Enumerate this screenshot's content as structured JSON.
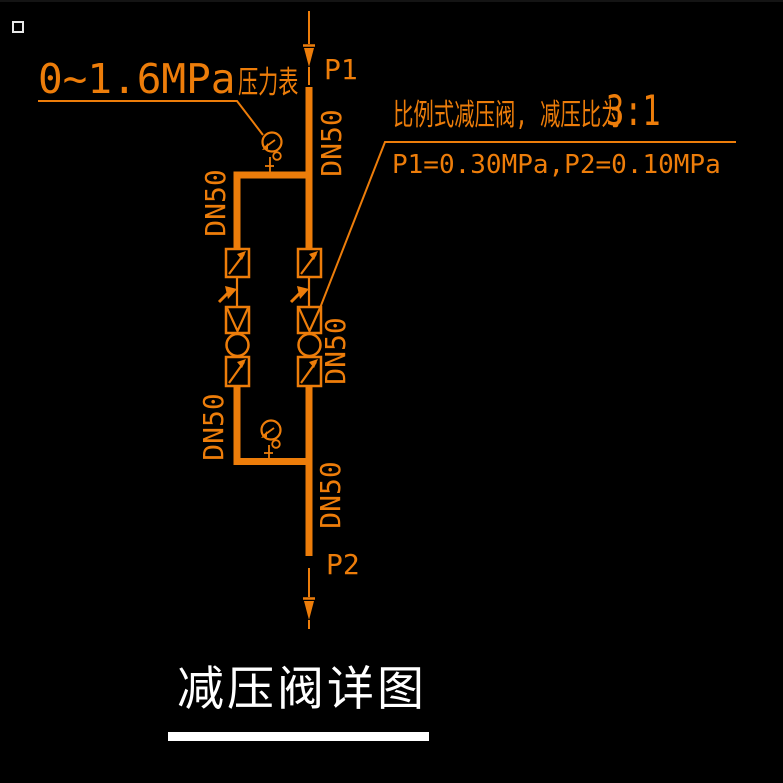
{
  "canvas": {
    "background": "#000000",
    "line_color": "#ED7D0A",
    "title_color": "#FFFFFF"
  },
  "labels": {
    "inlet": "P1",
    "outlet": "P2",
    "pipe_size": "DN50"
  },
  "annotations": {
    "gauge_range": "0~1.6MPa",
    "gauge_device": "压力表",
    "valve_note": "比例式减压阀, 减压比为",
    "valve_ratio": "3:1",
    "pressure_values": "P1=0.30MPa,P2=0.10MPa"
  },
  "title": {
    "text": "减压阀详图"
  },
  "icons": [
    "pick-box-marker",
    "inlet-flow-arrow-icon",
    "outlet-flow-arrow-icon",
    "pressure-gauge-icon",
    "stop-valve-icon",
    "pressure-reducing-valve-icon",
    "check-mark-icon"
  ]
}
